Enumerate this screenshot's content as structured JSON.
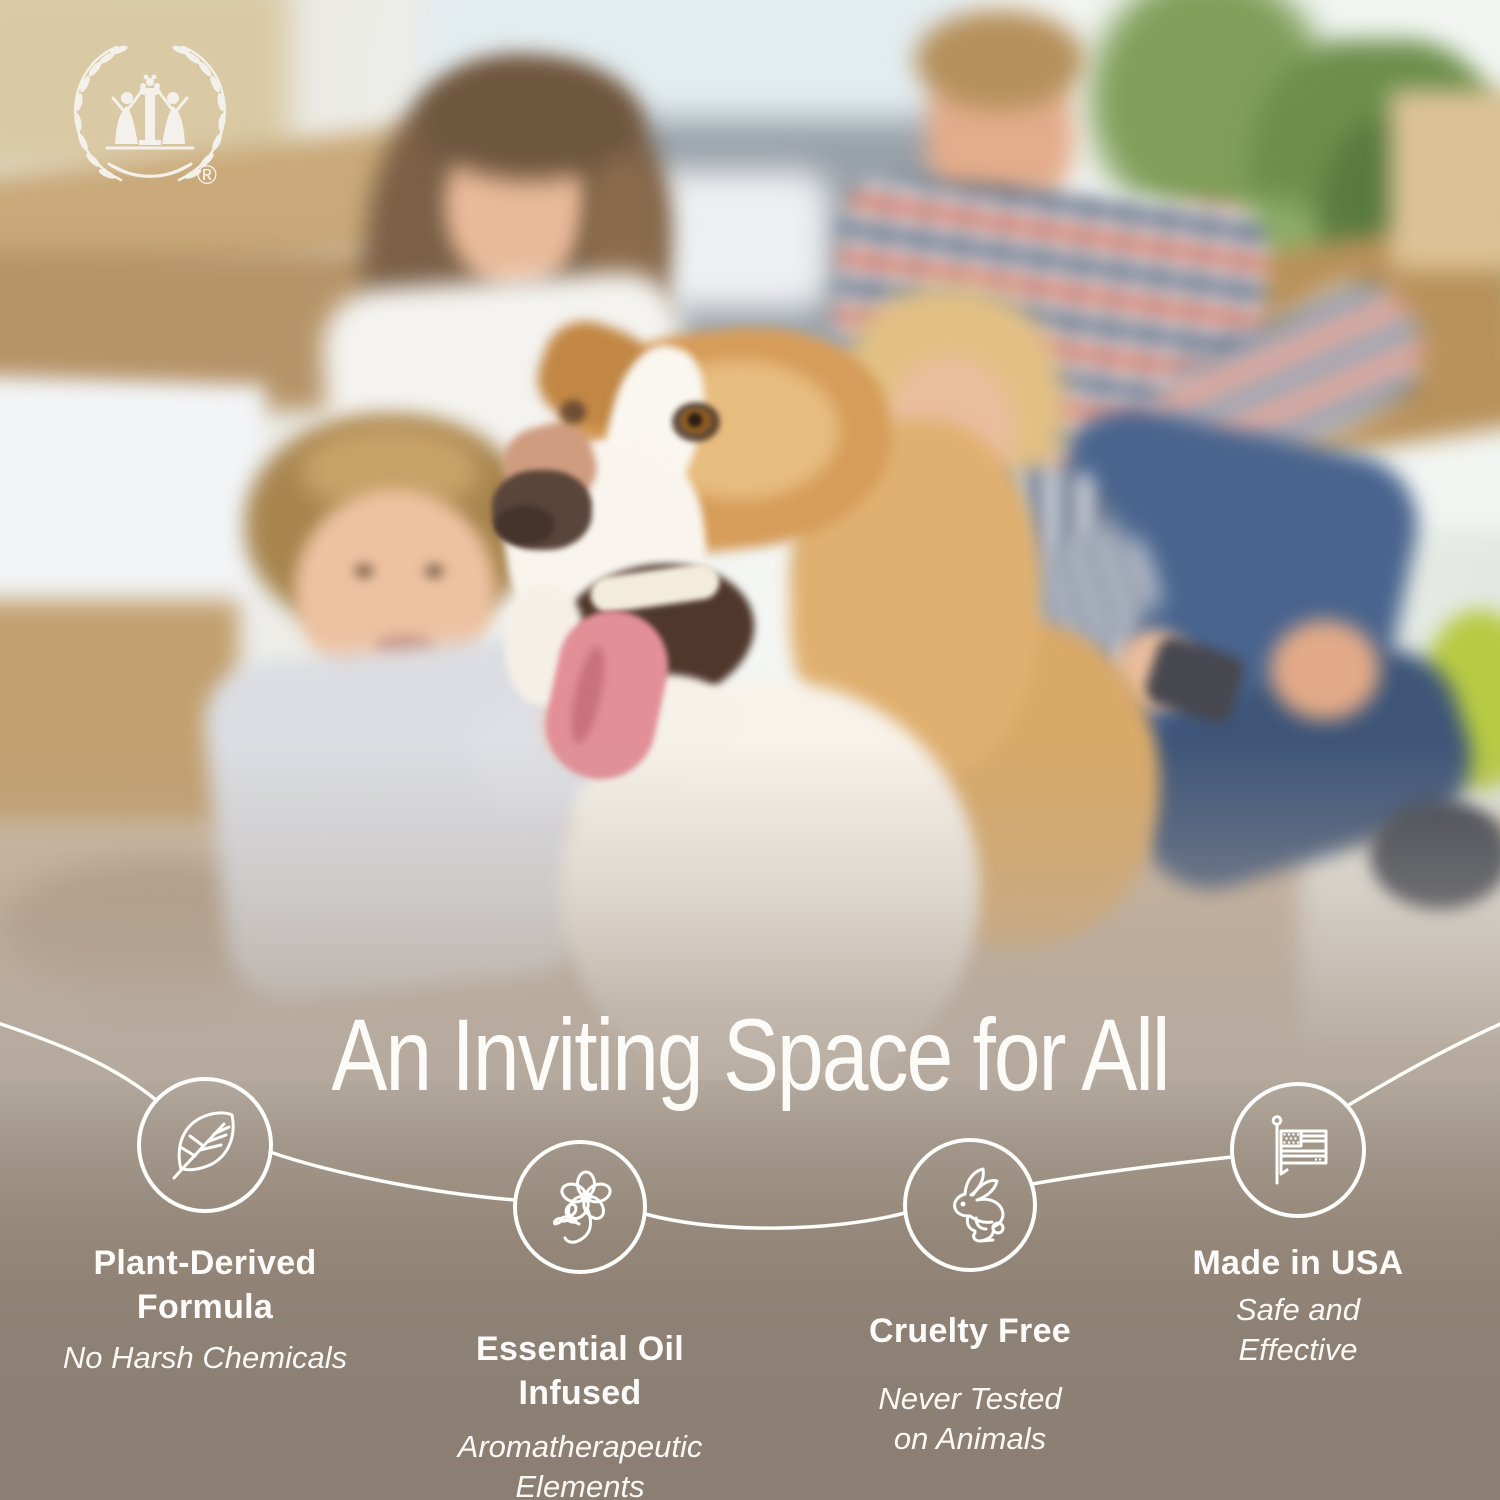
{
  "brand": {
    "logo": "laurel-wreath-children-fountain-logo",
    "registered_mark": "®"
  },
  "headline": "An Inviting Space for All",
  "features": [
    {
      "icon": "leaf-icon",
      "title": "Plant-Derived\nFormula",
      "subtitle": "No Harsh Chemicals"
    },
    {
      "icon": "flower-icon",
      "title": "Essential Oil\nInfused",
      "subtitle": "Aromatherapeutic\nElements"
    },
    {
      "icon": "rabbit-icon",
      "title": "Cruelty Free",
      "subtitle": "Never Tested\non Animals"
    },
    {
      "icon": "flag-usa-icon",
      "title": "Made in USA",
      "subtitle": "Safe and\nEffective"
    }
  ],
  "colors": {
    "background_taupe": "#8b7e72",
    "text_white": "#fcfbf8",
    "line_white": "#ffffff"
  },
  "scene": {
    "description": "Blurred photo: mother, father, son and daughter sitting on the floor of a bright living room with moving boxes and plants, petting a happy tan-and-white dog with its tongue out"
  }
}
